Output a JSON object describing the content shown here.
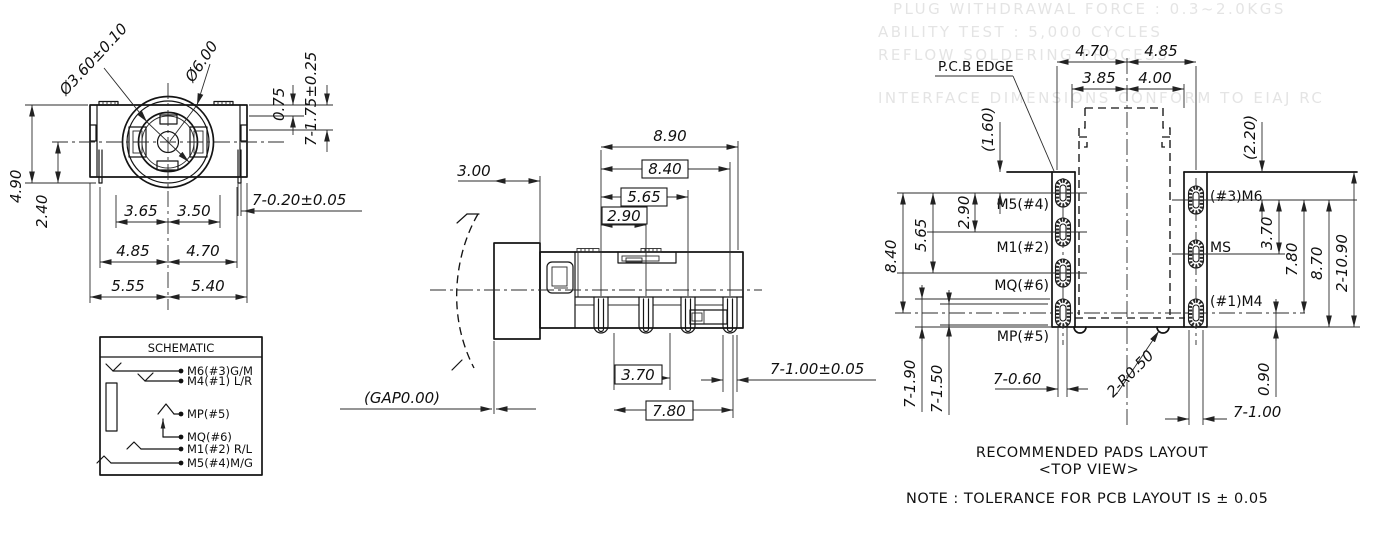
{
  "front_view": {
    "dims": {
      "hole_dia": "Ø3.60±0.10",
      "outer_dia": "Ø6.00",
      "step_depth": "0.75",
      "pins_len": "7-1.75±0.25",
      "height_total": "4.90",
      "height_lower": "2.40",
      "w1l": "3.65",
      "w1r": "3.50",
      "w2l": "4.85",
      "w2r": "4.70",
      "w3l": "5.55",
      "w3r": "5.40",
      "pin_thick": "7-0.20±0.05"
    }
  },
  "schematic": {
    "title": "SCHEMATIC",
    "pins": [
      "M6(#3)G/M",
      "M4(#1) L/R",
      "MP(#5)",
      "MQ(#6)",
      "M1(#2) R/L",
      "M5(#4)M/G"
    ]
  },
  "side_view": {
    "dims": {
      "front_len": "3.00",
      "total_len": "8.90",
      "len_840": "8.40",
      "len_565": "5.65",
      "len_290": "2.90",
      "pitch_370": "3.70",
      "len_780": "7.80",
      "pin_width": "7-1.00±0.05",
      "gap": "(GAP0.00)"
    }
  },
  "pcb_view": {
    "edge_label": "P.C.B EDGE",
    "top_dims": {
      "left_out": "4.70",
      "right_out": "4.85",
      "left_in": "3.85",
      "right_in": "4.00"
    },
    "left_dims": {
      "edge_to_pad": "(1.60)",
      "p12": "2.90",
      "p13": "5.65",
      "p14": "8.40",
      "pad_len": "7-1.90",
      "hole_len": "7-1.50",
      "hole_w": "7-0.60"
    },
    "right_dims": {
      "edge_to_pad": "(2.20)",
      "p12": "3.70",
      "p13": "7.80",
      "to_bottom": "8.70",
      "total": "2-10.90",
      "foot": "0.90",
      "pad_w": "7-1.00"
    },
    "radius": "2-R0.50",
    "pads_left": [
      "M5(#4)",
      "M1(#2)",
      "MQ(#6)",
      "MP(#5)"
    ],
    "pads_right": [
      "(#3)M6",
      "MS",
      "(#1)M4"
    ]
  },
  "footer": {
    "title": "RECOMMENDED PADS LAYOUT",
    "subtitle": "<TOP VIEW>",
    "note": "NOTE : TOLERANCE FOR PCB LAYOUT IS ± 0.05"
  },
  "ghost_text": [
    "PLUG WITHDRAWAL FORCE : 0.3~2.0KGS",
    "ABILITY TEST : 5,000 CYCLES",
    "REFLOW SOLDERING PROCESS",
    "INTERFACE DIMENSIONS CONFORM TO EIAJ RC"
  ]
}
